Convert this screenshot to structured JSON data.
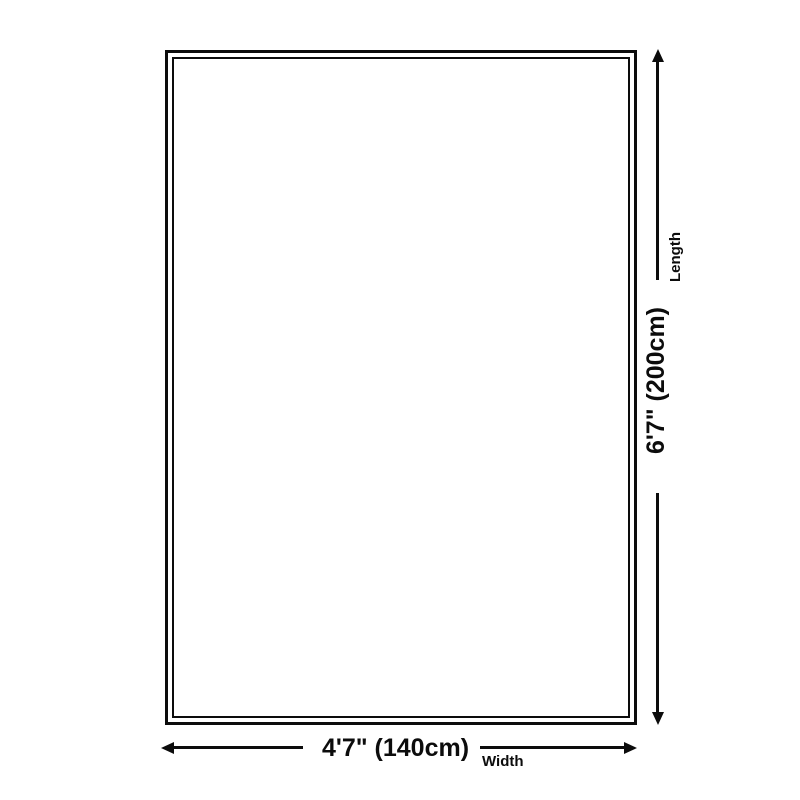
{
  "diagram": {
    "type": "product-dimension-diagram",
    "background_color": "#ffffff",
    "line_color": "#0c0c0c",
    "dimensions": {
      "length": {
        "value": "6'7\" (200cm)",
        "axis_label": "Length",
        "feet_inches": "6'7\"",
        "metric": "200cm",
        "orientation": "vertical"
      },
      "width": {
        "value": "4'7\" (140cm)",
        "axis_label": "Width",
        "feet_inches": "4'7\"",
        "metric": "140cm",
        "orientation": "horizontal"
      }
    }
  }
}
